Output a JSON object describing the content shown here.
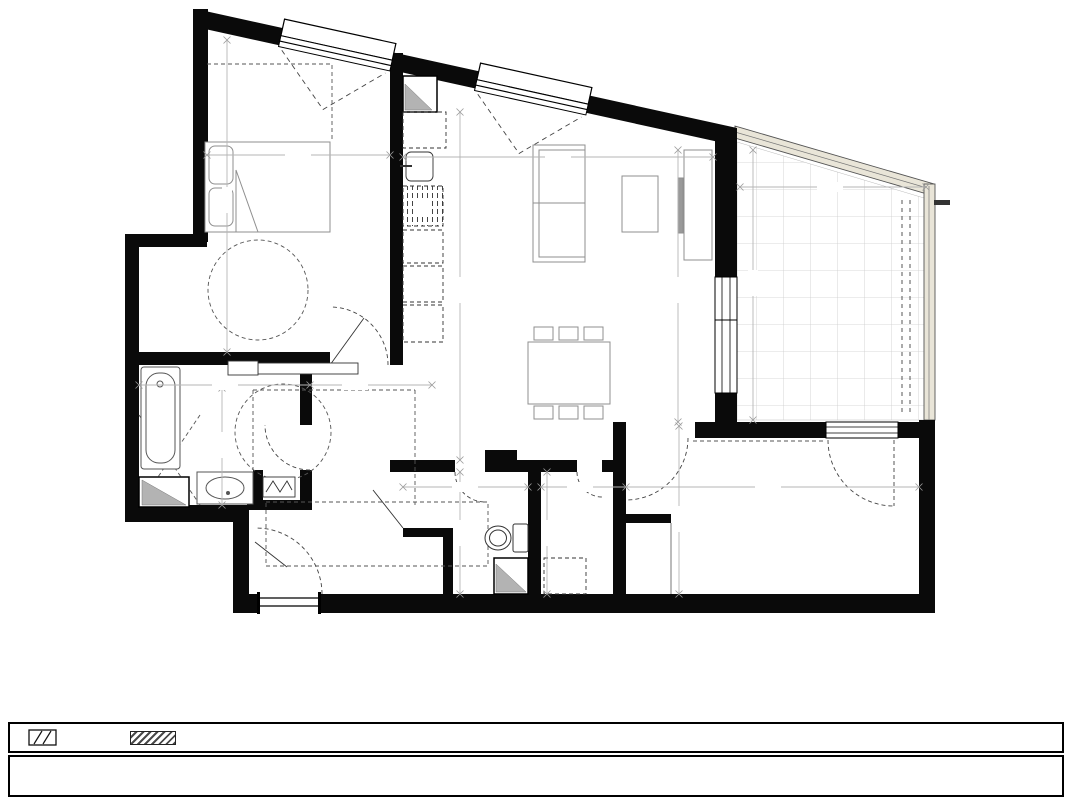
{
  "plan": {
    "rooms": {
      "chambre1": "Chambre 1",
      "cuisine_sejour": "Cuisine / Séjour",
      "terrasse": "terrasse",
      "sdb": "Sdb",
      "entree": "Entrée",
      "wc": "Wc",
      "buanderie": "Buanderie",
      "chambre2": "Chambre 2"
    },
    "dims": {
      "chambre1_w": "282",
      "chambre1_l": "497",
      "sejour_w": "488",
      "sejour_l": "548",
      "sejour_r": "432",
      "terrasse_w": "278",
      "terrasse_l": "416",
      "sdb_w": "250",
      "sdb_l": "218",
      "degagement_w": "122",
      "wc_w": "184",
      "wc_l": "200",
      "buanderie_w": "125",
      "buanderie_l": "200",
      "chambre2_w": "440",
      "chambre2_l": "252"
    },
    "labels": {
      "pl": "PL",
      "ll": "LL",
      "lv": "LV",
      "cui": "CUI",
      "fr": "FR",
      "ss": "SS",
      "vr": "VR",
      "f": "F",
      "pf": "PF"
    }
  },
  "annotations": {
    "abbrev": [
      {
        "key": "VR",
        "label": " : Volet roulant"
      },
      {
        "key": "F",
        "label": " : Fenêtre Fixe"
      },
      {
        "key": "PF",
        "label": " : Porte fenêtre"
      }
    ],
    "legende": {
      "text": "LEGENDE:  PL: Placard / CUI: Cuisson / FR: Réfrigerateur / LL: Lave Linge / LV: Lave Vaisselle / Soffite, faux plafond :",
      "cloison": "Cloison démontable"
    },
    "nota": {
      "title": "NOTA:",
      "lines": [
        "Les cotes et surfaces sont mentionnées à titre indicatif et sont susceptibles de variations dans les tolérances du contrat.Les gaines techniques, faux-plafonds, soffites connus sont mentionnés à titre indicatif. Pour des raisons techniques, administratives ou réglementaires, ils sont susceptibles d'être modifiés.",
        "La représentation des éléments de cuisine, de salle de bains et de mobilier n'ont qu'une valeur administrative. Seuls les éléments dans la notice descriptive de vente sont contractuels.La surface des placards est intégrée à la surface des pièces.",
        "La représentation graphique des haies et arbres est purement symbolique et n'a pas de caractère contractuel."
      ]
    }
  }
}
